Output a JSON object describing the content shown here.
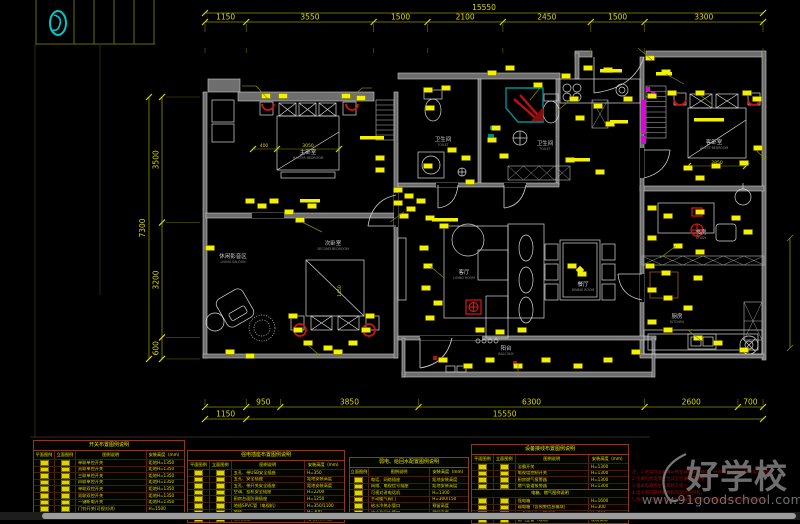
{
  "colors": {
    "dim_text": "#d8d800",
    "dim_line": "#8f8f00",
    "chip": "#f2f200",
    "wall": "#6e6e6e",
    "red": "#cc1414",
    "magenta": "#e000e0",
    "teal": "#009090",
    "legend_border": "#8a3a16"
  },
  "dimensions": {
    "top": {
      "overall": "15550",
      "segments": [
        "1150",
        "3550",
        "1500",
        "2100",
        "2450",
        "1500",
        "3300"
      ]
    },
    "left": {
      "overall": "7300",
      "segments": [
        "3500",
        "3200",
        "600"
      ]
    },
    "bottom": {
      "row1_segments": [
        "950",
        "3850",
        "6300",
        "2600",
        "700"
      ],
      "row2_first": "1150",
      "row2_overall": "15550"
    }
  },
  "plan_dim_labels": [
    "3050",
    "400",
    "1450",
    "2850"
  ],
  "rooms": [
    {
      "zh": "主卧室",
      "en": "MASTER BEDROOM"
    },
    {
      "zh": "休闲影音区",
      "en": "LIVING SALOON"
    },
    {
      "zh": "次卧室",
      "en": "SECOND BEDROOM"
    },
    {
      "zh": "卫生间",
      "en": "TOILET"
    },
    {
      "zh": "卫生间",
      "en": "TOILET"
    },
    {
      "zh": "客厅",
      "en": "LIVING ROOM"
    },
    {
      "zh": "餐厅",
      "en": "DINING ROOM"
    },
    {
      "zh": "阳台",
      "en": "BALCONY"
    },
    {
      "zh": "书房",
      "en": "STUDY"
    },
    {
      "zh": "厨房",
      "en": "KITCHEN"
    },
    {
      "zh": "客卧室",
      "en": "GUEST BEDROOM"
    }
  ],
  "legend_tables": [
    {
      "title": "开关布置图例说明",
      "headers": [
        "平面图例",
        "立面图例",
        "图例说明",
        "安装高度（mm）"
      ],
      "rows": [
        [
          "单联单控开关",
          "距地H=1350"
        ],
        [
          "双联单控开关",
          "距地H=1350"
        ],
        [
          "三联单控开关",
          "距地H=1350"
        ],
        [
          "四联单控开关",
          "距地H=1350"
        ],
        [
          "单联双控开关",
          "距地H=1350"
        ],
        [
          "双联双控开关",
          "距地H=1350"
        ],
        [
          "一键断电开关",
          "距地H=1350"
        ],
        [
          "门铃开关(可视对讲)",
          "H=1500"
        ],
        [
          "浴霸开关(集成吊顶)",
          "H=1350"
        ]
      ]
    },
    {
      "title": "强电插座布置图例说明",
      "headers": [
        "平面图例",
        "立面图例",
        "图例说明",
        "安装高度（mm）"
      ],
      "rows": [
        [
          "五孔、带USB安全插座",
          "H=350"
        ],
        [
          "五孔、安全插座",
          "距地安装高度"
        ],
        [
          "五孔、带开关安全插座",
          "距地安装高度"
        ],
        [
          "空调、挂机安全插座",
          "H=2200"
        ],
        [
          "厨房台面防溅插座",
          "H=1250"
        ],
        [
          "地插SPVC管（电视机）",
          "H=350/1100"
        ],
        [
          "地插",
          "H=300"
        ],
        [
          "烟机插座",
          "距地安装高度"
        ]
      ]
    },
    {
      "title": "弱电、给回水配置图例说明",
      "headers": [
        "立面图例",
        "图例说明",
        "安装高度（mm）"
      ],
      "rows": [
        [
          "电话、网络插座",
          "距地安装高度"
        ],
        [
          "网络、电视信号插座",
          "距地安装高度"
        ],
        [
          "可视对讲电话机",
          "H=1300"
        ],
        [
          "手动暖气阀门",
          "H=300/150"
        ],
        [
          "给水冷热水管口",
          "预留高度"
        ],
        [
          "给水及回水管口",
          "预留高度"
        ]
      ]
    },
    {
      "title": "设备接线布置图例说明",
      "headers": [
        "平面图例",
        "立面图例",
        "图例说明",
        "安装高度（mm）"
      ],
      "rows": [
        [
          "浴霸开关",
          "H=1300"
        ],
        [
          "电视墙控制开关",
          "H=1300"
        ],
        [
          "厨房燃气报警器",
          "H=1300"
        ],
        [
          "燃气管道报警器",
          "H=1300"
        ]
      ],
      "subheader": "电箱、燃气图例说明",
      "rows2": [
        [
          "强电箱",
          "H=1600"
        ],
        [
          "弱电箱（含预警信息模块）",
          "H=300"
        ],
        [
          "三角阀冷热水管阀门",
          "H=300"
        ],
        [
          "燃气立管（现场）",
          "现场实际"
        ]
      ]
    }
  ],
  "notes": {
    "lines": [
      "注：1.水电改造前请与物业现场交底确认，开关插座定位以现场实际为准；",
      "2.空调内机电源定位详见空调配置图纸；",
      "3.强弱电箱移位（现场交底）；",
      "4.电子图纸最终解释权归设计方所有；",
      "5.厨房、卫生间、阳台均需做防水试验（具体以现场实际情况布置为准）"
    ]
  },
  "watermark": {
    "brand": "好学校",
    "url": "www.91goodschool.com"
  }
}
